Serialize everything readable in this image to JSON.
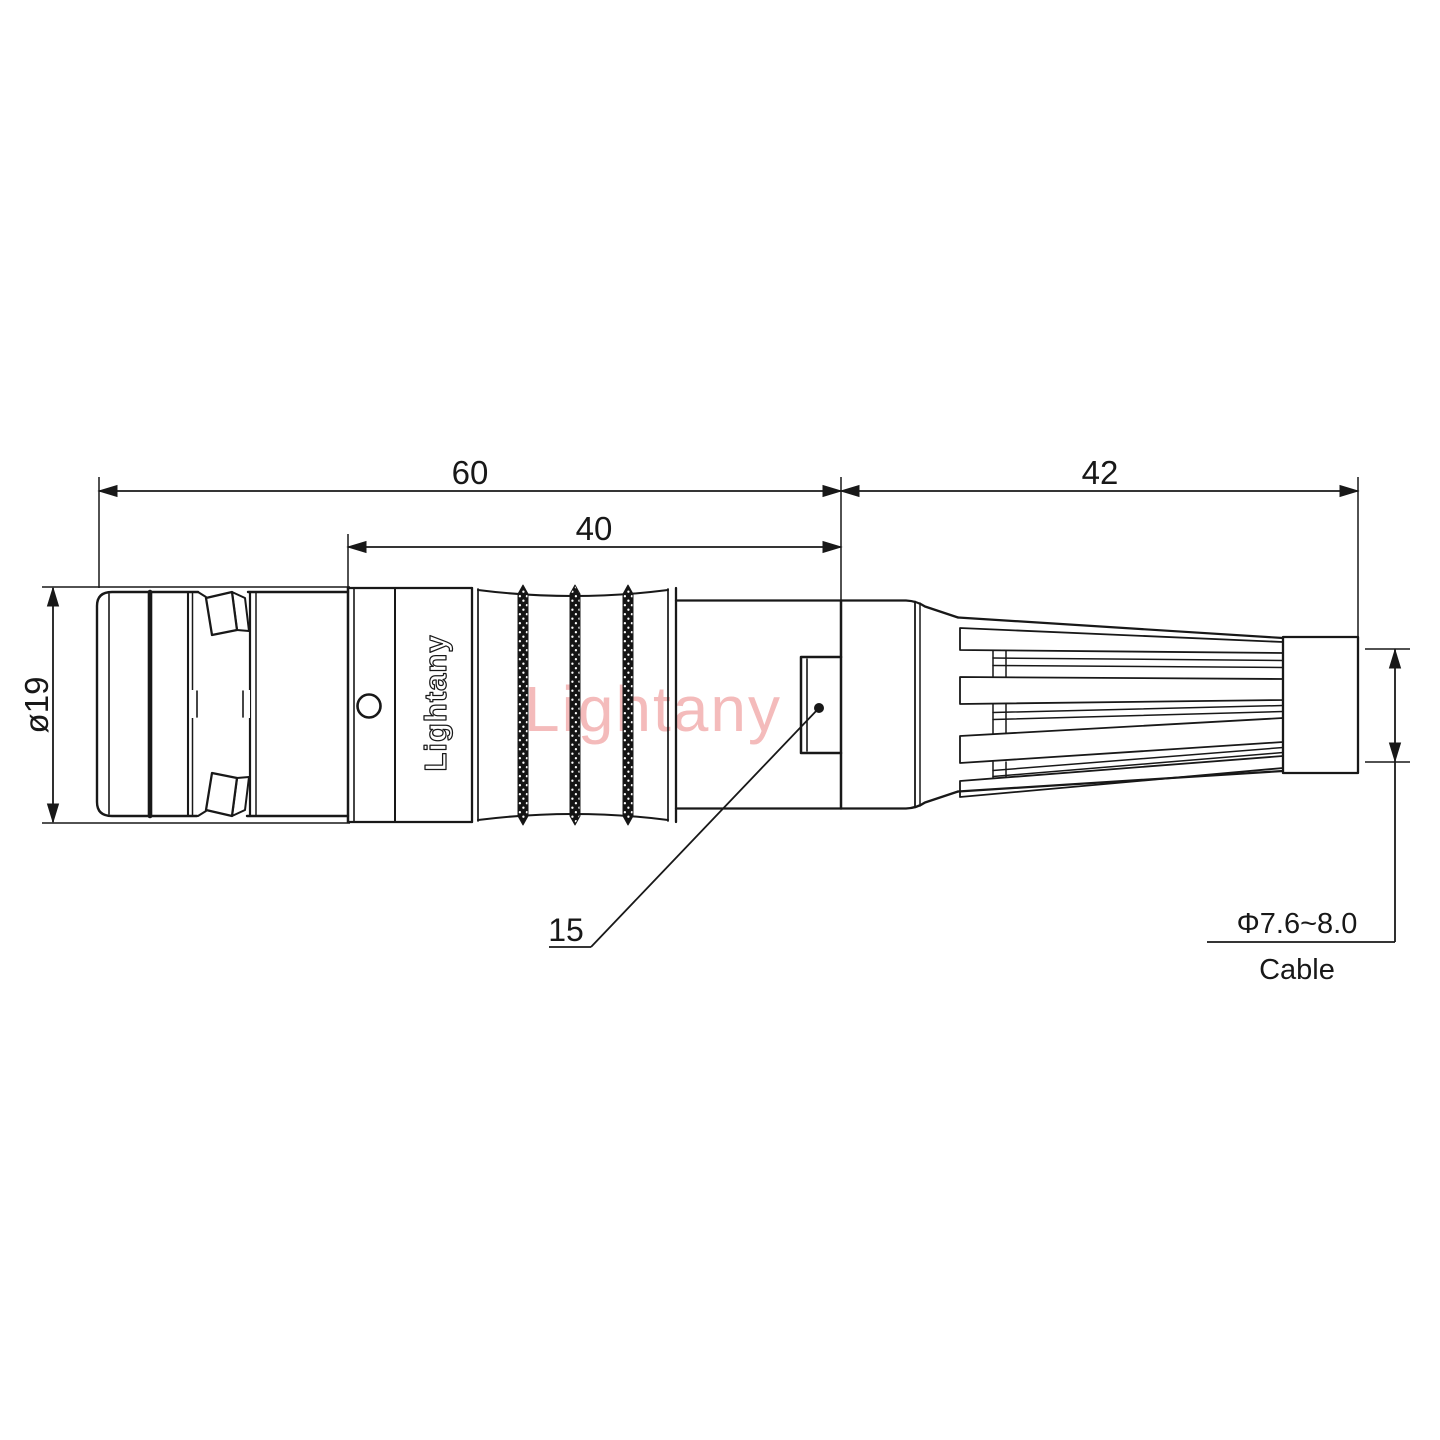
{
  "watermark": "Lightany",
  "body_logo": "Lightany",
  "dims": {
    "overall": "60",
    "body": "40",
    "rear": "42",
    "diameter": "ø19",
    "feature": "15",
    "cable_diameter": "Φ7.6~8.0",
    "cable_label": "Cable"
  },
  "colors": {
    "line": "#181818",
    "watermark": "#f3b4b4",
    "background": "#ffffff"
  }
}
